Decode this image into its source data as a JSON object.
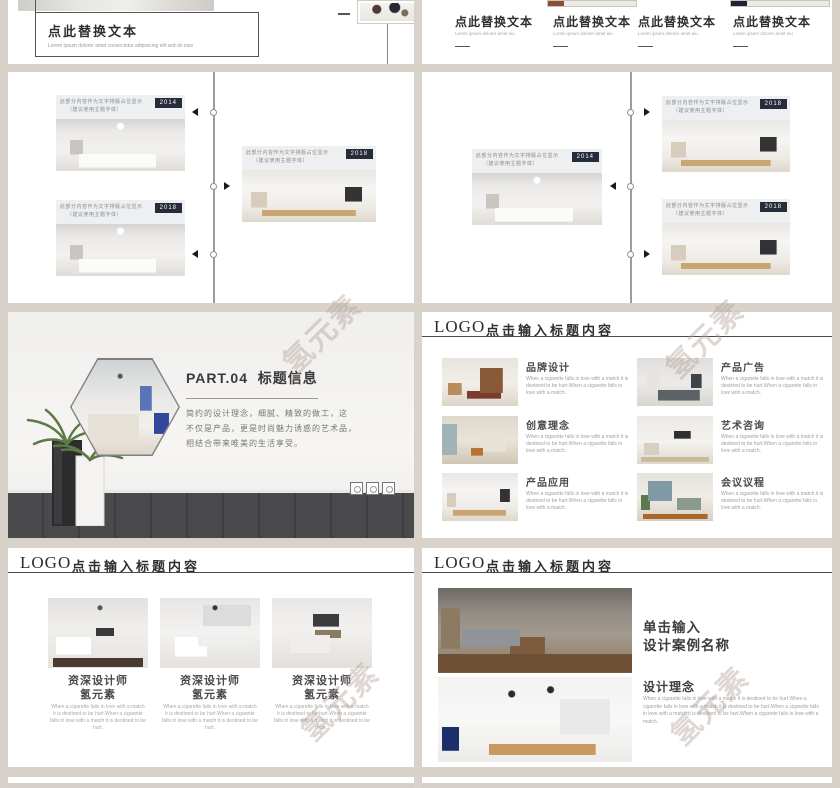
{
  "page": {
    "background_color": "#d8d2ca",
    "watermark_text": "氢元素"
  },
  "colors": {
    "badge_navy": "#272c3a",
    "accent_brown": "#8a5136",
    "accent_navy": "#1c2333",
    "header_line": "#4a4a4a"
  },
  "header": {
    "logo": "LOGO",
    "title": "点击输入标题内容"
  },
  "slide1_left": {
    "title": "点此替换文本",
    "subtitle": "Lorem ipsum dolorer amet consectetur adipisicing elit sed do eius"
  },
  "slide1_right": {
    "columns": [
      {
        "title": "点此替换文本",
        "sub": "Lorem ipsum dolorer amet eiu"
      },
      {
        "title": "点此替换文本",
        "sub": "Lorem ipsum dolorer amet eiu"
      },
      {
        "title": "点此替换文本",
        "sub": "Lorem ipsum dolorer amet eiu"
      },
      {
        "title": "点此替换文本",
        "sub": "Lorem ipsum dolorer amet eiu"
      }
    ]
  },
  "timeline_card": {
    "line1": "此部分内容作为文字排版占位显示",
    "line2": "（建议使用主题字体）"
  },
  "slide2_left": {
    "years": [
      "2014",
      "2018",
      "2018"
    ]
  },
  "slide2_right": {
    "years": [
      "2018",
      "2014",
      "2018"
    ]
  },
  "slide3_left": {
    "part_label": "PART.04",
    "title": "标题信息",
    "body_lines": [
      "简约的设计理念，细腻、精致的做工，这",
      "不仅是产品，更是时尚魅力诱惑的艺术品，",
      "相结合带来唯美的生活享受。"
    ]
  },
  "slide3_right": {
    "items": [
      {
        "title": "品牌设计"
      },
      {
        "title": "产品广告"
      },
      {
        "title": "创意理念"
      },
      {
        "title": "艺术咨询"
      },
      {
        "title": "产品应用"
      },
      {
        "title": "会议议程"
      }
    ],
    "item_desc": "When a cigarette falls in love with a match it is destined to be hurt.When a cigarette falls in love with a match."
  },
  "slide4_left": {
    "cards": [
      {
        "name": "资深设计师",
        "sub": "氢元素"
      },
      {
        "name": "资深设计师",
        "sub": "氢元素"
      },
      {
        "name": "资深设计师",
        "sub": "氢元素"
      }
    ],
    "card_desc": "When a cigarette falls in love with a match it is destined to be hurt.When a cigarette falls in love with a match it is destined to be hurt."
  },
  "slide4_right": {
    "title_line1": "单击输入",
    "title_line2": "设计案例名称",
    "section_title": "设计理念",
    "desc": "When a cigarette falls in love with a match it is destined to be hurt.When a cigarette falls in love with a match it is destined to be hurt.When a cigarette falls in love with a match it is destined to be hurt.When a cigarette falls in love with a match."
  }
}
